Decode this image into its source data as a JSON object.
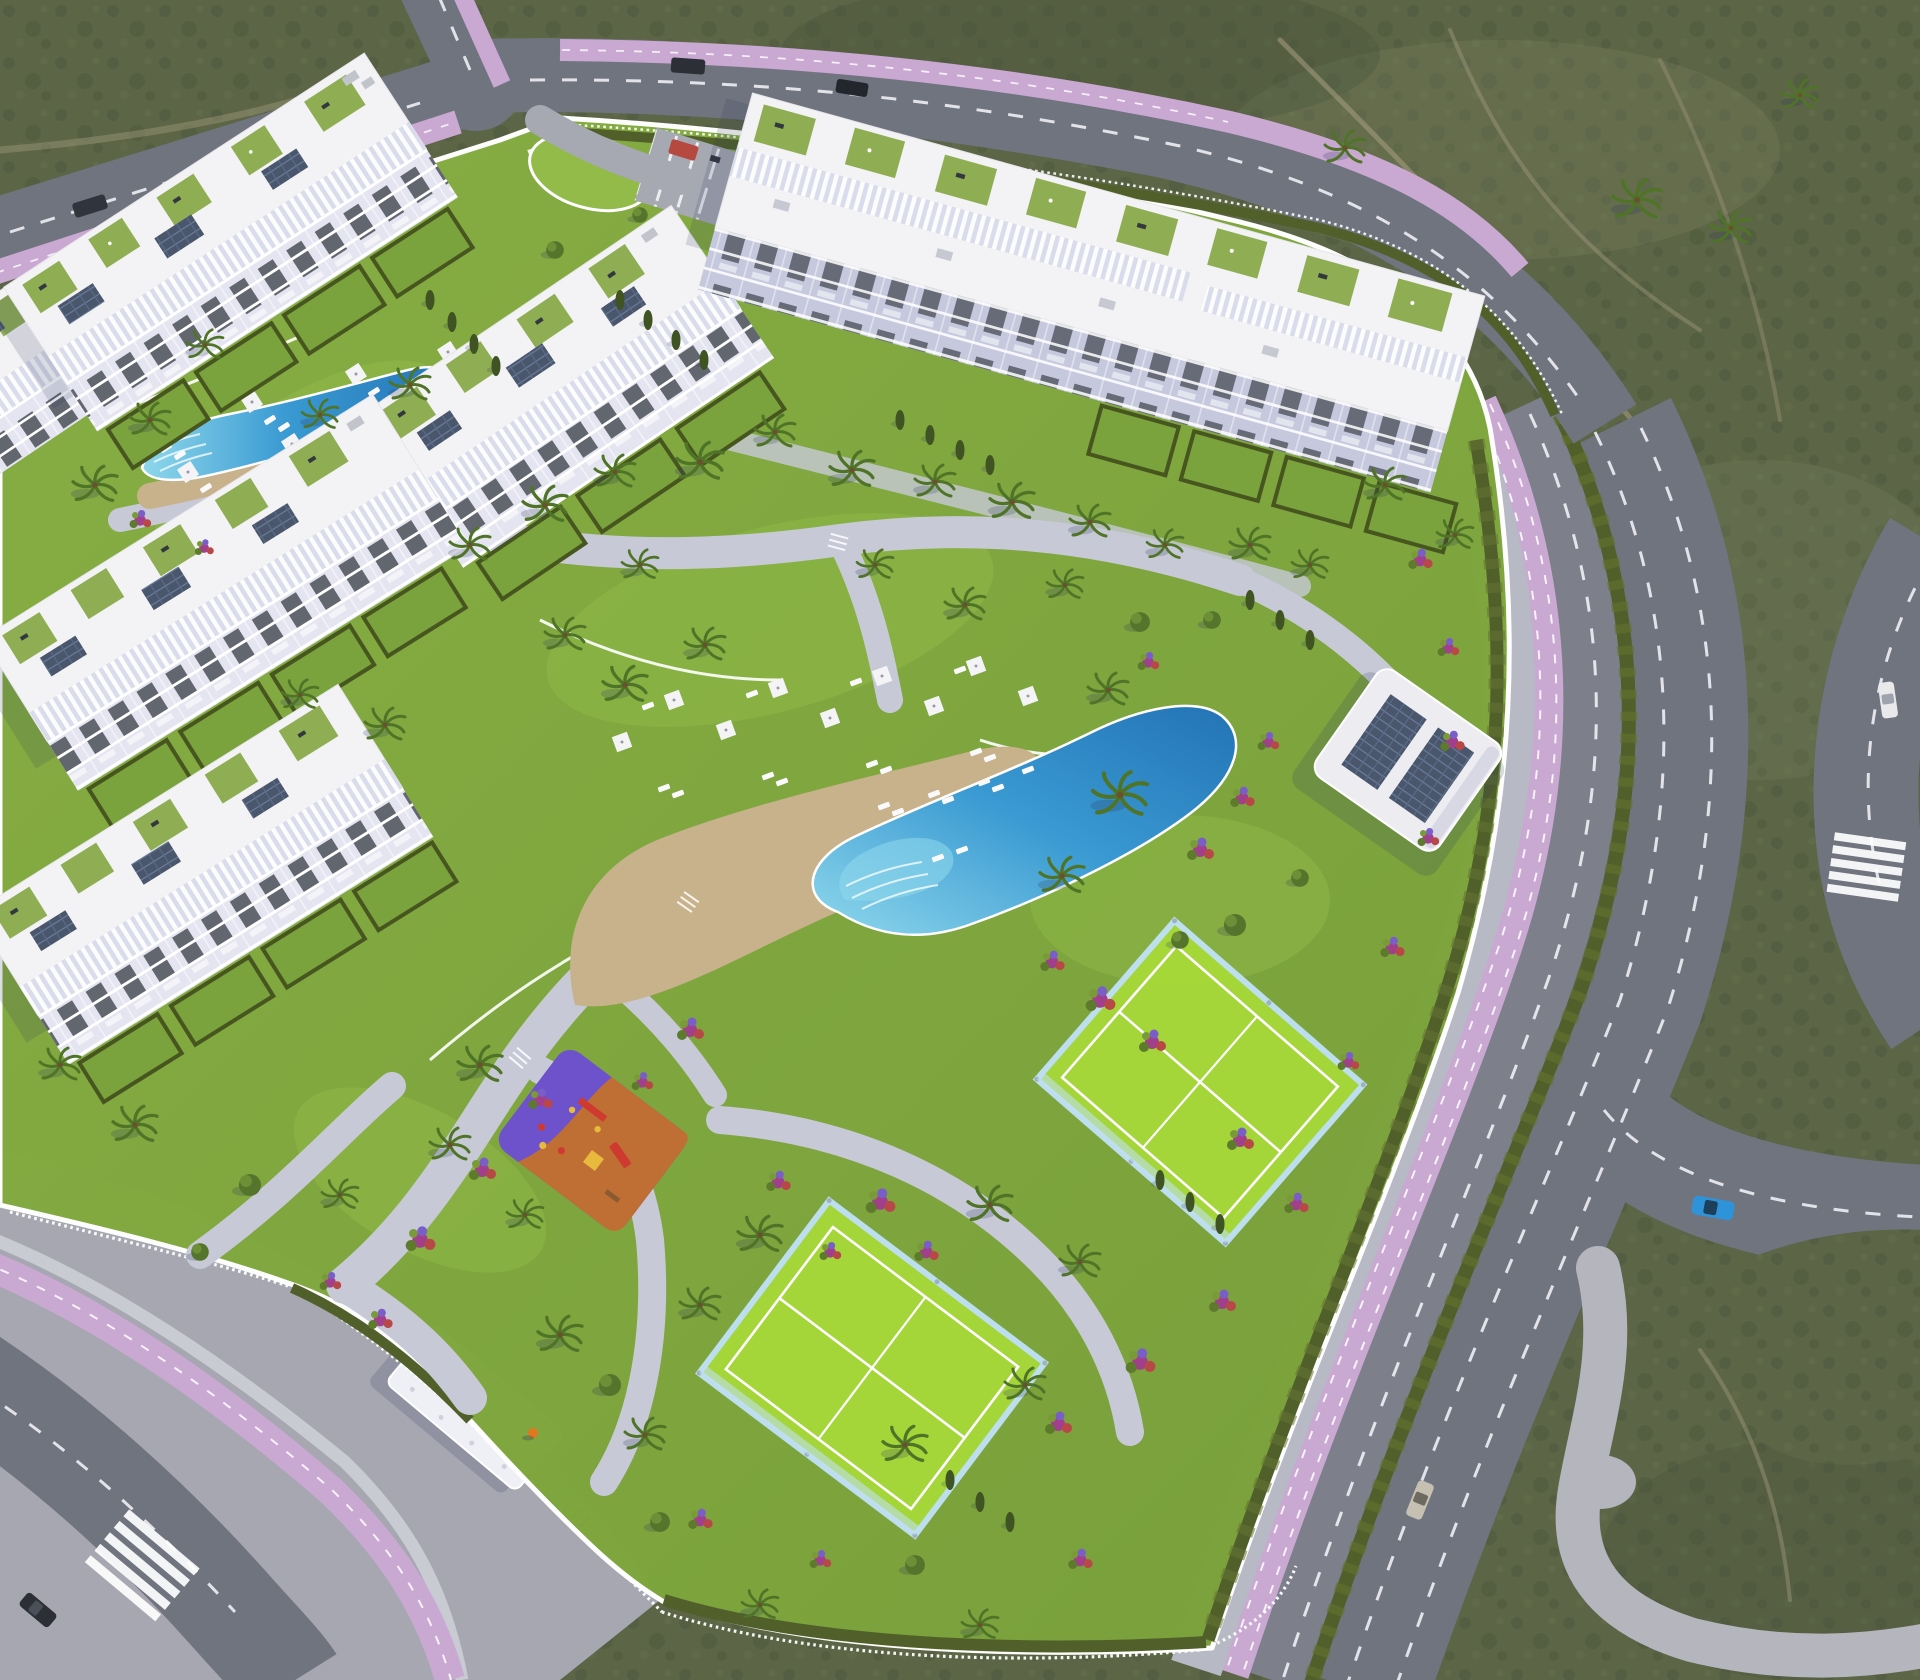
{
  "meta": {
    "kind": "aerial-3d-architectural-render",
    "subject": "Mediterranean apartment resort complex surrounded by scrubland and roads",
    "view": "high oblique aerial"
  },
  "colors": {
    "scrub": "#5c6546",
    "scrubDark": "#49523a",
    "scrubLight": "#798260",
    "dirt": "#a89f82",
    "road": "#70747f",
    "roadLight": "#7d808b",
    "laneLine": "#eef0f4",
    "bike": "#c9a8d2",
    "sidewalk": "#b7b9c4",
    "plaza": "#a6a7b0",
    "path": "#c7c9d7",
    "lawn": "#7ea43e",
    "lawnBright": "#92bb4a",
    "hedge": "#51602a",
    "cypress": "#3f5422",
    "palm": "#4f7428",
    "sand": "#c8b28c",
    "pool": "#3a9ad2",
    "poolDeep": "#2373b5",
    "poolLight": "#8fd8ec",
    "court": "#a6d83a",
    "courtLine": "#ffffff",
    "glass": "#bfe0f2",
    "playOrange": "#bf6f33",
    "playPurple": "#6e52cc",
    "playRed": "#cf3a30",
    "playYellow": "#e7b93c",
    "building": "#f3f2f4",
    "facade": "#e4e5f0",
    "facadeShade": "#c6c9de",
    "window": "#41464f",
    "terrace": "#8fae54",
    "panel": "#49566b",
    "wall": "#ffffff",
    "shadow": "#2e3560",
    "carBlue": "#2e93d8",
    "carSilver": "#c6c0b2",
    "carWhite": "#e9e9ec",
    "carDark": "#2c2f36",
    "carRed": "#b5493f",
    "flower1": "#a23f8c",
    "flower2": "#b84848",
    "flower3": "#7a5ec8",
    "umbrella": "#f4f4f6"
  },
  "scene": {
    "environment": {
      "surroundings": "olive-green scrubland with dirt trails",
      "lighting": "warm low sun, shadows to south-west"
    },
    "buildings": [
      {
        "id": "apartment-block-1",
        "position": "top-left",
        "features": [
          "roof terraces",
          "pergola slats",
          "solar panels",
          "balcony facade",
          "private gardens"
        ]
      },
      {
        "id": "apartment-block-2",
        "position": "top-right long block",
        "features": [
          "roof terraces",
          "pergola slats",
          "shaded balcony facade",
          "private gardens"
        ]
      },
      {
        "id": "apartment-block-3",
        "position": "center",
        "features": [
          "roof terraces",
          "pergola slats",
          "solar panels",
          "balcony facade"
        ]
      },
      {
        "id": "apartment-block-4",
        "position": "left middle",
        "features": [
          "roof terraces",
          "pergola slats",
          "solar panels",
          "private gardens"
        ]
      },
      {
        "id": "apartment-block-5",
        "position": "left lower",
        "features": [
          "roof terraces",
          "pergola slats",
          "solar panels",
          "private gardens"
        ]
      },
      {
        "id": "apartment-block-6",
        "position": "left edge partial",
        "features": [
          "roof terraces"
        ]
      },
      {
        "id": "clubhouse",
        "position": "east side",
        "features": [
          "flat roof",
          "two solar arrays"
        ]
      }
    ],
    "amenities": [
      {
        "id": "main-pool",
        "shape": "lagoon with beach entry",
        "deck": "sand colored",
        "loungers": 22,
        "umbrellas": 9
      },
      {
        "id": "upper-pool",
        "shape": "elongated with steps",
        "loungers": 12,
        "umbrellas": 7
      },
      {
        "id": "playground",
        "surfaces": [
          "orange",
          "purple"
        ],
        "equipment": [
          "swings",
          "slide",
          "tower",
          "spring riders"
        ]
      },
      {
        "id": "padel-court-upper",
        "surface": "lime green, white lines, glass walls"
      },
      {
        "id": "padel-court-lower",
        "surface": "lime green, white lines, glass walls"
      },
      {
        "id": "parking-area",
        "position": "top center",
        "marked_bays": true
      },
      {
        "id": "entrance-canopy",
        "position": "south-west gate"
      },
      {
        "id": "bike-racks",
        "position": "near south-west gate"
      }
    ],
    "roads": [
      {
        "id": "boulevard-east",
        "elements": [
          "sidewalk",
          "pink bike lane with dashes",
          "frontage lane",
          "hedge median",
          "two-lane road",
          "u-turn branch",
          "edge road"
        ]
      },
      {
        "id": "road-top",
        "elements": [
          "dashed center line",
          "pink bike lane",
          "parked cars"
        ]
      },
      {
        "id": "road-northwest",
        "elements": [
          "dashed center line",
          "pink bike lane"
        ]
      },
      {
        "id": "road-north-arm",
        "elements": [
          "pink bike lane"
        ]
      },
      {
        "id": "road-southwest",
        "elements": [
          "crosswalk",
          "pink bike lane",
          "paved plaza"
        ]
      },
      {
        "id": "stone-path-southeast",
        "elements": [
          "irregular paved pedestrian path"
        ]
      }
    ],
    "vehicles": [
      {
        "id": "car-blue",
        "location": "east u-turn branch"
      },
      {
        "id": "car-silver",
        "location": "east road lower"
      },
      {
        "id": "car-white",
        "location": "right edge road"
      },
      {
        "id": "car-dark",
        "location": "south-west crosswalk"
      },
      {
        "id": "car-red-parked",
        "location": "parking area"
      },
      {
        "id": "cars-dark-parked",
        "location": "top road",
        "count": 2
      }
    ],
    "vegetation": {
      "palm_trees": 46,
      "cypresses": 21,
      "flower_beds": 26,
      "hedges": "perimeter and medians"
    },
    "people": [
      {
        "id": "pedestrian",
        "location": "near lower padel court"
      }
    ]
  }
}
